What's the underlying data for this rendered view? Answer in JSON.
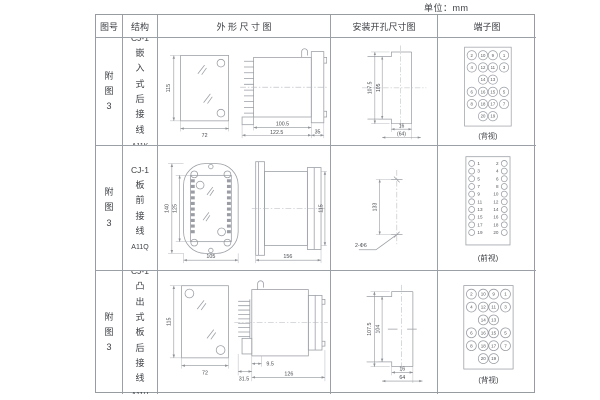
{
  "unit_label": "单位：mm",
  "header": {
    "fig_no": "图号",
    "structure": "结构",
    "outline": "外 形 尺 寸 图",
    "install": "安装开孔尺寸图",
    "terminal": "端子图"
  },
  "rows": [
    {
      "fig": "附图3",
      "model": "CJ-1",
      "structure": "嵌入式后接线",
      "code": "A11K",
      "outline": {
        "height": "115",
        "width": "72",
        "d1": "100.5",
        "d2": "122.5",
        "d3": "35"
      },
      "install": {
        "v1": "107.5",
        "v2": "105",
        "b1": "16",
        "b2": "(64)"
      },
      "terminal": {
        "view": "(背视)",
        "grid": [
          [
            "2",
            "10",
            "9",
            "1"
          ],
          [
            "4",
            "12",
            "11",
            "3"
          ],
          [
            "",
            "14",
            "13",
            ""
          ],
          [
            "6",
            "16",
            "15",
            "5"
          ],
          [
            "8",
            "18",
            "17",
            "7"
          ],
          [
            "",
            "20",
            "19",
            ""
          ]
        ]
      }
    },
    {
      "fig": "附图3",
      "model": "CJ-1",
      "structure": "板前接线",
      "code": "A11Q",
      "outline": {
        "height": "140",
        "inner_height": "125",
        "width": "105",
        "length": "156",
        "side_height": "115"
      },
      "install": {
        "v1": "133",
        "hole": "2-Φ6"
      },
      "terminal": {
        "view": "(前视)",
        "left": [
          "1",
          "3",
          "5",
          "7",
          "9",
          "11",
          "13",
          "15",
          "17",
          "19"
        ],
        "right": [
          "2",
          "4",
          "6",
          "8",
          "10",
          "12",
          "14",
          "16",
          "18",
          "20"
        ]
      }
    },
    {
      "fig": "附图3",
      "model": "CJ-1",
      "structure": "凸出式板后接线",
      "code": "A11H",
      "outline": {
        "height": "115",
        "width": "72",
        "d1": "9.5",
        "d2": "31.5",
        "d3": "126"
      },
      "install": {
        "v1": "107.5",
        "v2": "104",
        "b1": "16",
        "b2": "64"
      },
      "terminal": {
        "view": "(背视)",
        "grid": [
          [
            "2",
            "10",
            "9",
            "1"
          ],
          [
            "4",
            "12",
            "11",
            "3"
          ],
          [
            "",
            "14",
            "13",
            ""
          ],
          [
            "6",
            "16",
            "15",
            "5"
          ],
          [
            "8",
            "18",
            "17",
            "7"
          ],
          [
            "",
            "20",
            "19",
            ""
          ]
        ]
      }
    }
  ]
}
